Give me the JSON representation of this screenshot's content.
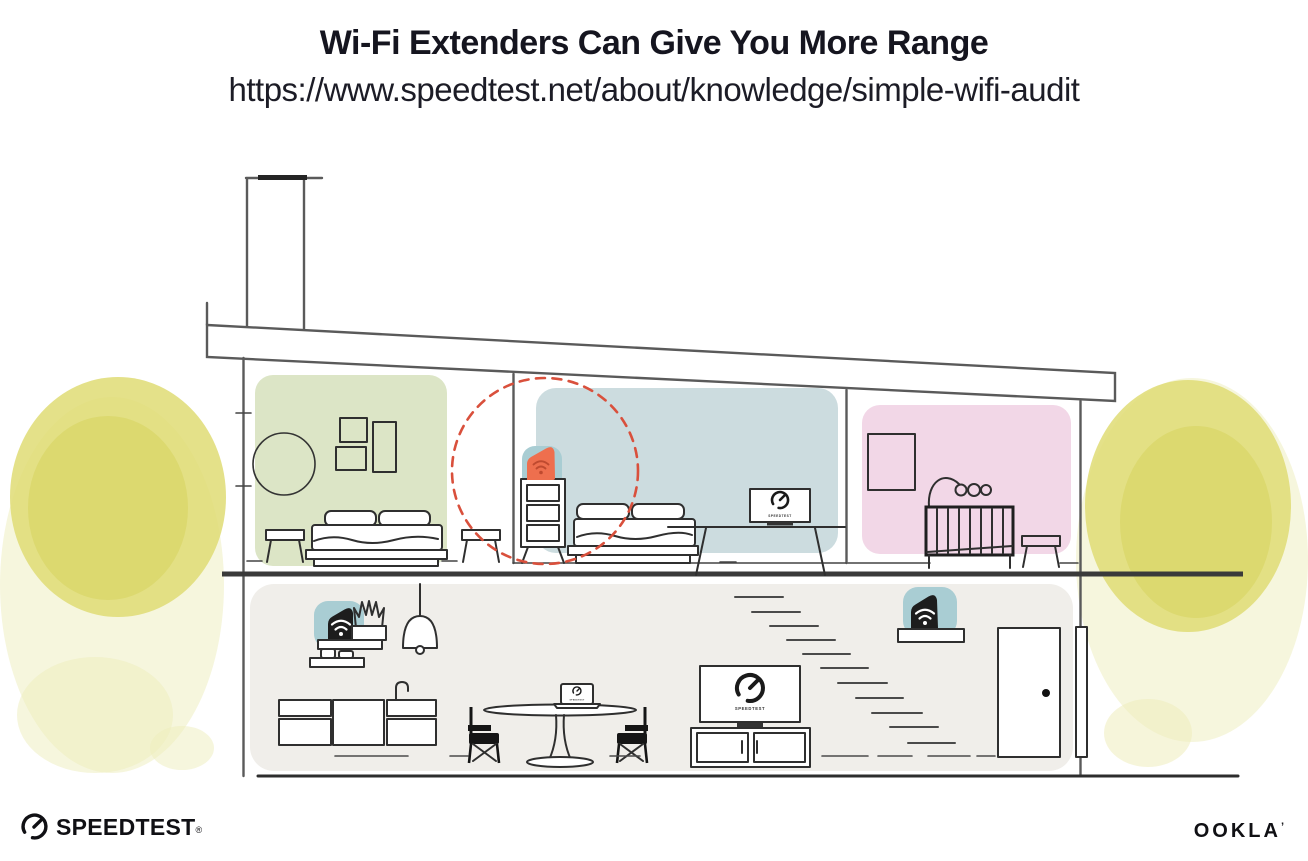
{
  "header": {
    "title": "Wi-Fi Extenders Can Give You More Range",
    "url": "https://www.speedtest.net/about/knowledge/simple-wifi-audit"
  },
  "device_screens": {
    "living_tv_label": "SPEEDTEST",
    "bedroom_tv_label": "SPEEDTEST",
    "laptop_label": "SPEEDTEST"
  },
  "footer": {
    "speedtest_wordmark": "SPEEDTEST",
    "registered_mark": "®",
    "ookla_wordmark": "OOKLA",
    "trademark_tick": "’"
  },
  "icons": {
    "wifi": "wifi-icon",
    "speedtest_gauge": "speedtest-gauge-icon"
  },
  "colors": {
    "room_green": "#dce5c6",
    "room_blue": "#ccdcdf",
    "room_pink": "#f2d7e7",
    "ground_floor_gray": "#f0eeea",
    "device_teal": "#a9cdd3",
    "extender_orange": "#ee6f4e",
    "extender_wifi_dark": "#bf4a2f",
    "device_black": "#1d1d1d",
    "foliage_yellow": "#dfdc74",
    "foliage_yellow_light": "#eeedbb",
    "foliage_yellow_dark": "#d5d159",
    "coverage_dashed_red": "#d9503c"
  }
}
